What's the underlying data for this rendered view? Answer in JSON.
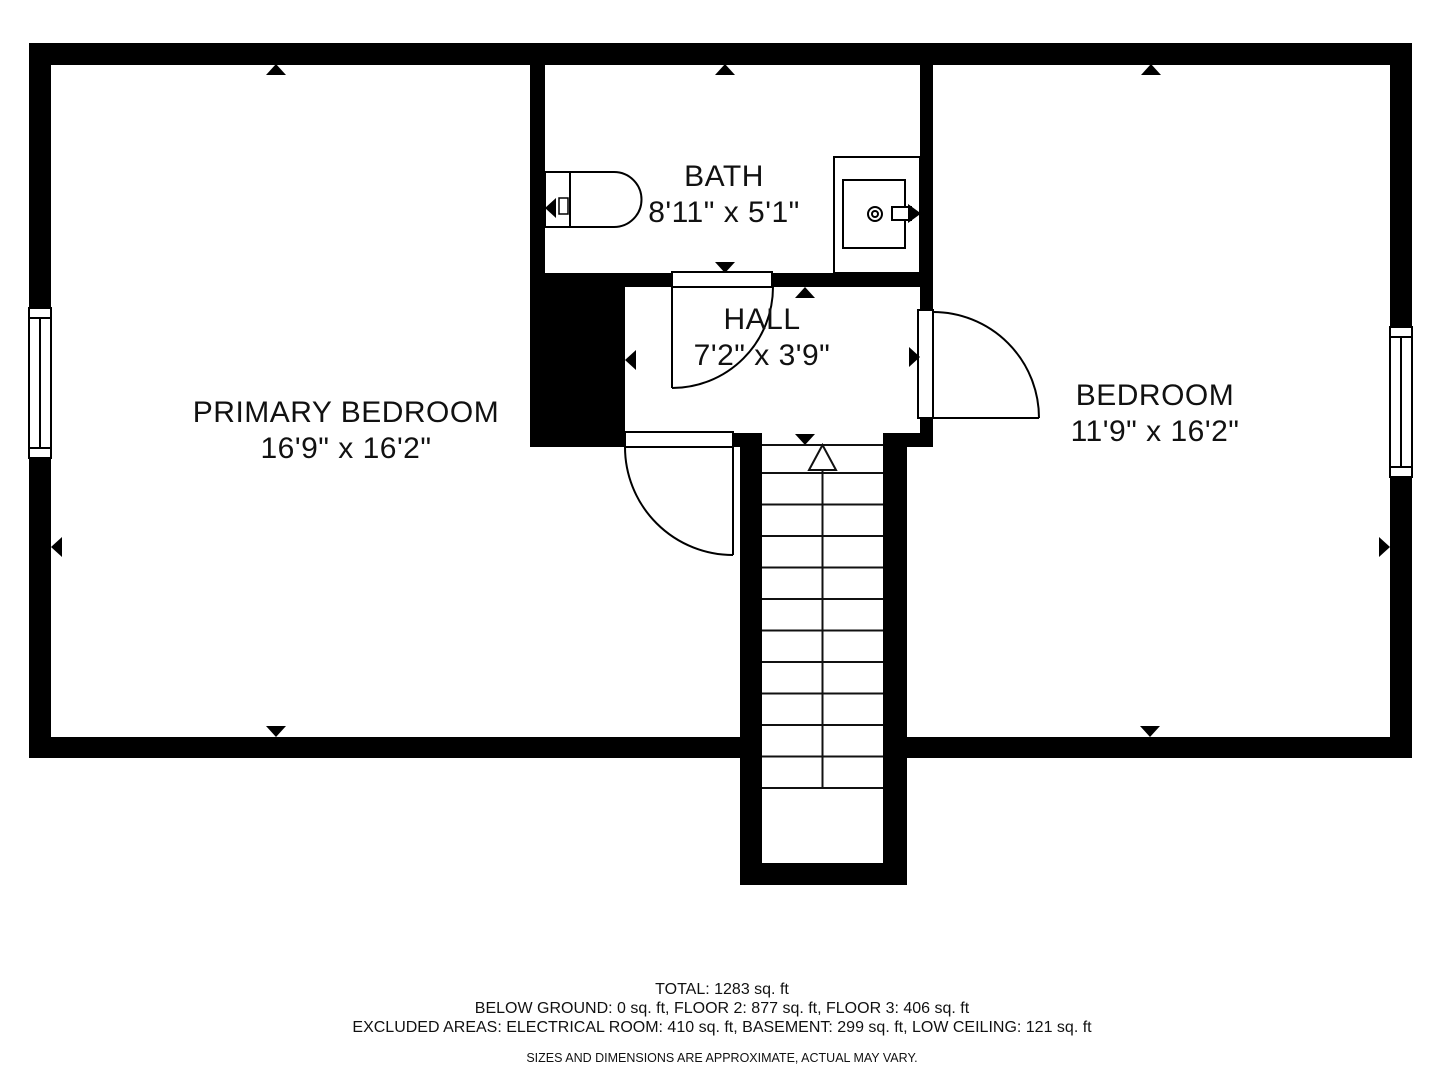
{
  "rooms": [
    {
      "name": "PRIMARY BEDROOM",
      "dimensions": "16'9\" x 16'2\""
    },
    {
      "name": "BATH",
      "dimensions": "8'11\" x 5'1\""
    },
    {
      "name": "HALL",
      "dimensions": "7'2\" x 3'9\""
    },
    {
      "name": "BEDROOM",
      "dimensions": "11'9\" x 16'2\""
    }
  ],
  "footer": {
    "total": "TOTAL: 1283 sq. ft",
    "floors": "BELOW GROUND: 0 sq. ft, FLOOR 2: 877 sq. ft, FLOOR 3: 406 sq. ft",
    "excluded": "EXCLUDED AREAS: ELECTRICAL ROOM: 410 sq. ft, BASEMENT: 299 sq. ft, LOW CEILING: 121 sq. ft",
    "disclaimer": "SIZES AND DIMENSIONS ARE APPROXIMATE, ACTUAL MAY VARY."
  },
  "colors": {
    "wall": "#000000",
    "background": "#ffffff",
    "line": "#111111"
  }
}
